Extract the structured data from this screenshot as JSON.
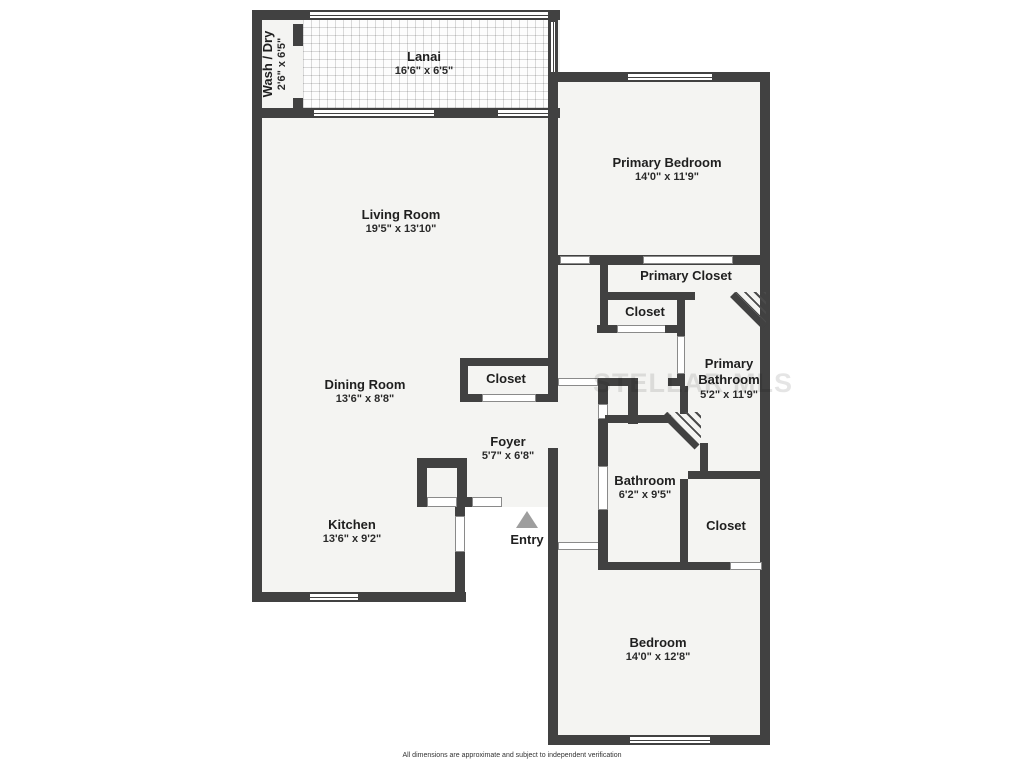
{
  "plan": {
    "watermark": "STELLAR MLS",
    "disclaimer": "All dimensions are approximate and subject to independent verification",
    "colors": {
      "wall": "#414141",
      "room_fill": "#f4f4f2",
      "entry_arrow": "#9e9e9e"
    },
    "rooms": {
      "wash_dry": {
        "name": "Wash / Dry",
        "dims": "2'6\" x 6'5\""
      },
      "lanai": {
        "name": "Lanai",
        "dims": "16'6\" x 6'5\""
      },
      "living_room": {
        "name": "Living Room",
        "dims": "19'5\" x 13'10\""
      },
      "primary_bedroom": {
        "name": "Primary Bedroom",
        "dims": "14'0\" x 11'9\""
      },
      "primary_closet": {
        "name": "Primary Closet"
      },
      "closet_hall": {
        "name": "Closet"
      },
      "primary_bathroom": {
        "name": "Primary Bathroom",
        "dims": "5'2\" x 11'9\""
      },
      "dining_room": {
        "name": "Dining Room",
        "dims": "13'6\" x 8'8\""
      },
      "closet_foyer": {
        "name": "Closet"
      },
      "foyer": {
        "name": "Foyer",
        "dims": "5'7\" x 6'8\""
      },
      "bathroom": {
        "name": "Bathroom",
        "dims": "6'2\" x 9'5\""
      },
      "closet_bathroom": {
        "name": "Closet"
      },
      "kitchen": {
        "name": "Kitchen",
        "dims": "13'6\" x 9'2\""
      },
      "entry": {
        "name": "Entry"
      },
      "bedroom": {
        "name": "Bedroom",
        "dims": "14'0\" x 12'8\""
      }
    }
  }
}
